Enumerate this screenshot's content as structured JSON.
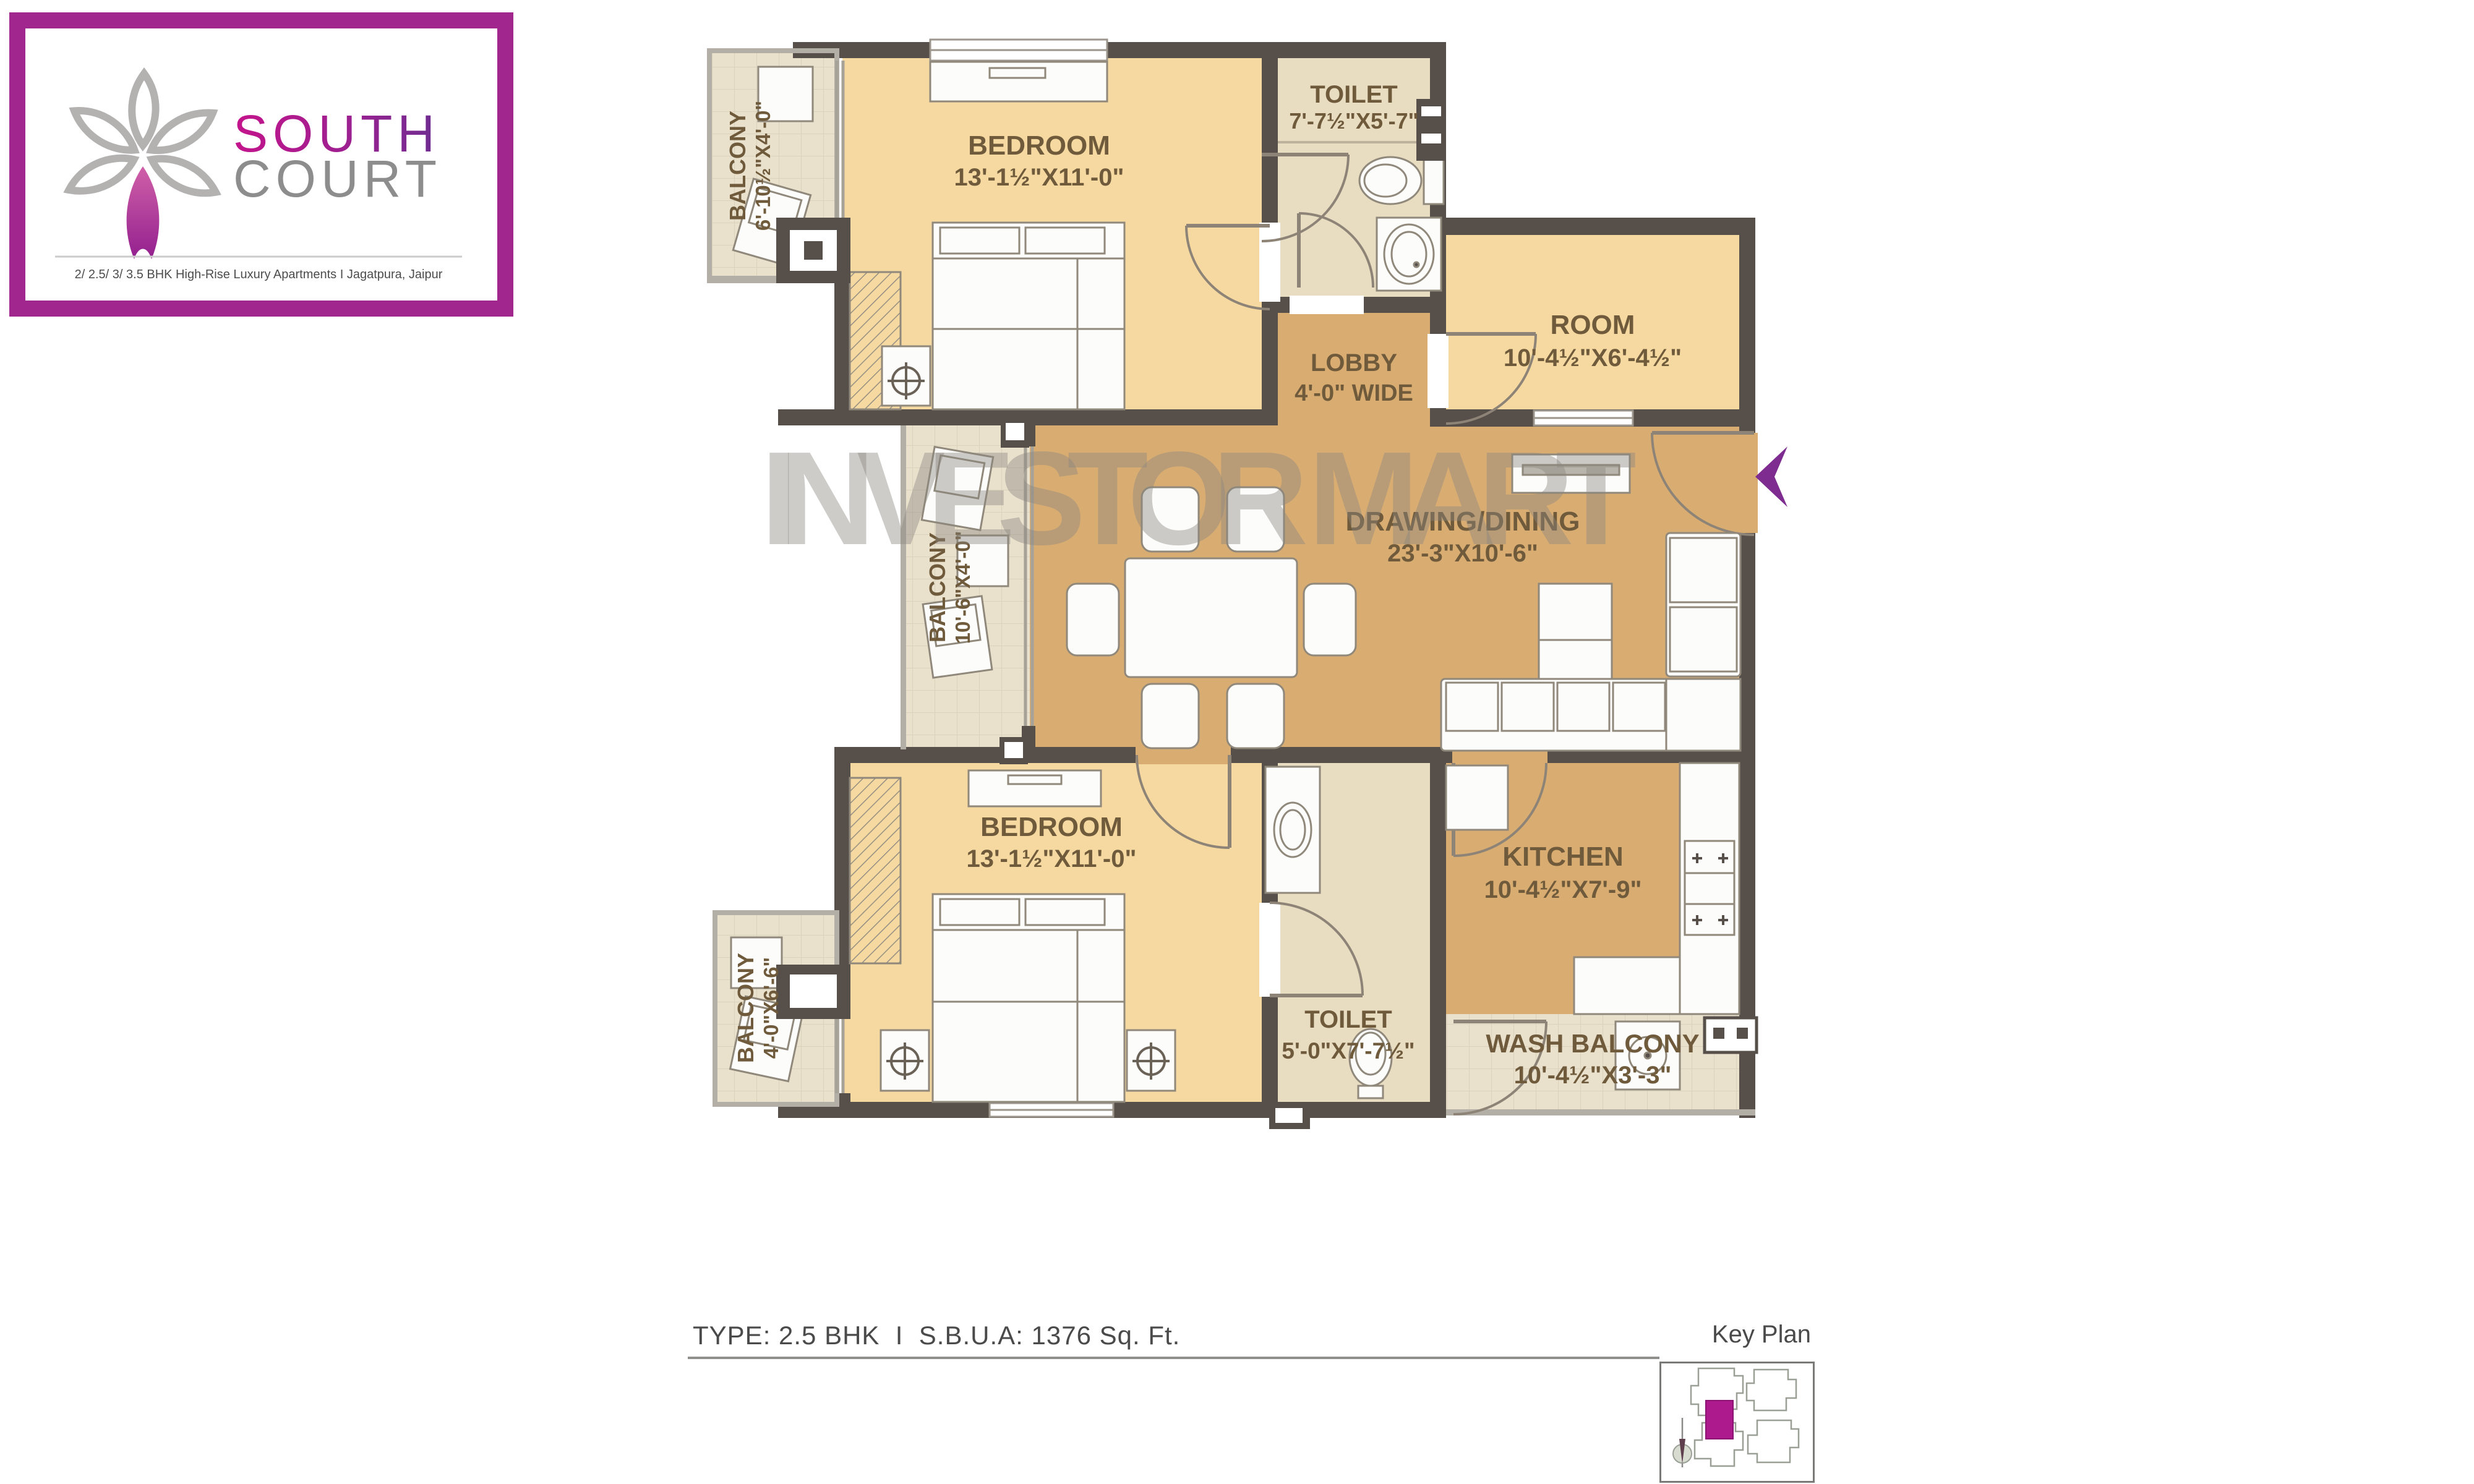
{
  "logo": {
    "brand_line1": "SOUTH",
    "brand_line2": "COURT",
    "tagline": "2/ 2.5/ 3/ 3.5 BHK High-Rise Luxury Apartments  I  Jagatpura, Jaipur",
    "colors": {
      "border": "#a1268d",
      "south_gradient_start": "#c4148c",
      "south_gradient_end": "#6d2d91",
      "court": "#8d8d8d",
      "petal_gray": "#b4b1b1",
      "petal_purple": "#93208f"
    }
  },
  "watermark": {
    "text": "INVESTOR MART"
  },
  "floor_plan": {
    "rooms": [
      {
        "id": "balcony-top-left",
        "name": "BALCONY",
        "dim": "6'-10½\"X4'-0\""
      },
      {
        "id": "bedroom-top",
        "name": "BEDROOM",
        "dim": "13'-1½\"X11'-0\""
      },
      {
        "id": "toilet-top",
        "name": "TOILET",
        "dim": "7'-7½\"X5'-7\""
      },
      {
        "id": "room",
        "name": "ROOM",
        "dim": "10'-4½\"X6'-4½\""
      },
      {
        "id": "lobby",
        "name": "LOBBY",
        "dim": "4'-0\" WIDE"
      },
      {
        "id": "drawing-dining",
        "name": "DRAWING/DINING",
        "dim": "23'-3\"X10'-6\""
      },
      {
        "id": "balcony-mid-left",
        "name": "BALCONY",
        "dim": "10'-6\"X4'-0\""
      },
      {
        "id": "bedroom-bottom",
        "name": "BEDROOM",
        "dim": "13'-1½\"X11'-0\""
      },
      {
        "id": "balcony-bottom-left",
        "name": "BALCONY",
        "dim": "4'-0\"X6'-6\""
      },
      {
        "id": "toilet-bottom",
        "name": "TOILET",
        "dim": "5'-0\"X7'-7½\""
      },
      {
        "id": "kitchen",
        "name": "KITCHEN",
        "dim": "10'-4½\"X7'-9\""
      },
      {
        "id": "wash-balcony",
        "name": "WASH BALCONY",
        "dim": "10'-4½\"X3'-3\""
      }
    ],
    "colors": {
      "wall": "#57504a",
      "room_fill": "#f5d9a1",
      "living_fill": "#d9ad72",
      "toilet_fill": "#e8dcc1",
      "balcony_fill": "#eae1cd",
      "label": "#6f5b3c",
      "entry_arrow": "#7e2c8f",
      "watermark": "#8a867f"
    }
  },
  "footer": {
    "type_info": "TYPE: 2.5 BHK  I  S.B.U.A: 1376 Sq. Ft.",
    "key_plan_label": "Key Plan"
  }
}
